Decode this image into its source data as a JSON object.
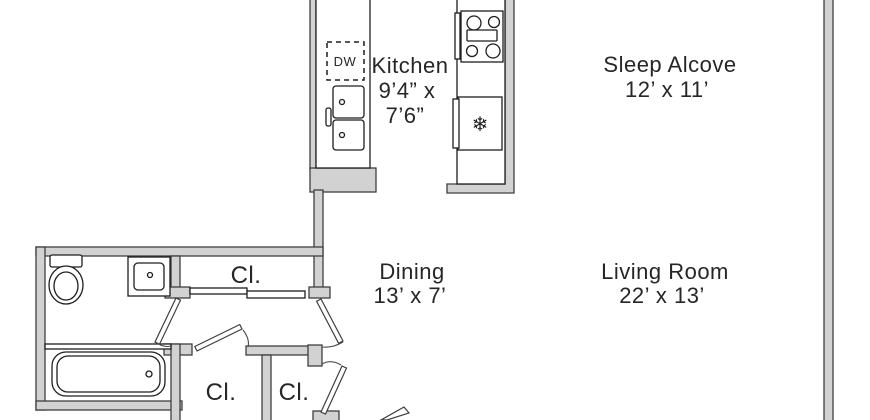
{
  "rooms": {
    "kitchen": {
      "name": "Kitchen",
      "dimension_line1": "9’4” x",
      "dimension_line2": "7’6”"
    },
    "sleep_alcove": {
      "name": "Sleep Alcove",
      "dimension": "12’ x 11’"
    },
    "dining": {
      "name": "Dining",
      "dimension": "13’ x 7’"
    },
    "living_room": {
      "name": "Living Room",
      "dimension": "22’ x 13’"
    },
    "closet_hall": {
      "abbr": "Cl."
    },
    "closet_lower_left": {
      "abbr": "Cl."
    },
    "closet_lower_right": {
      "abbr": "Cl."
    }
  },
  "appliances": {
    "dishwasher_label": "DW",
    "fridge_icon": "❄"
  },
  "colors": {
    "background": "#ffffff",
    "wall_fill": "#d2d2d2",
    "wall_outline": "#3f3f3f",
    "fixture_outline": "#1e1e1e",
    "text": "#262626"
  }
}
